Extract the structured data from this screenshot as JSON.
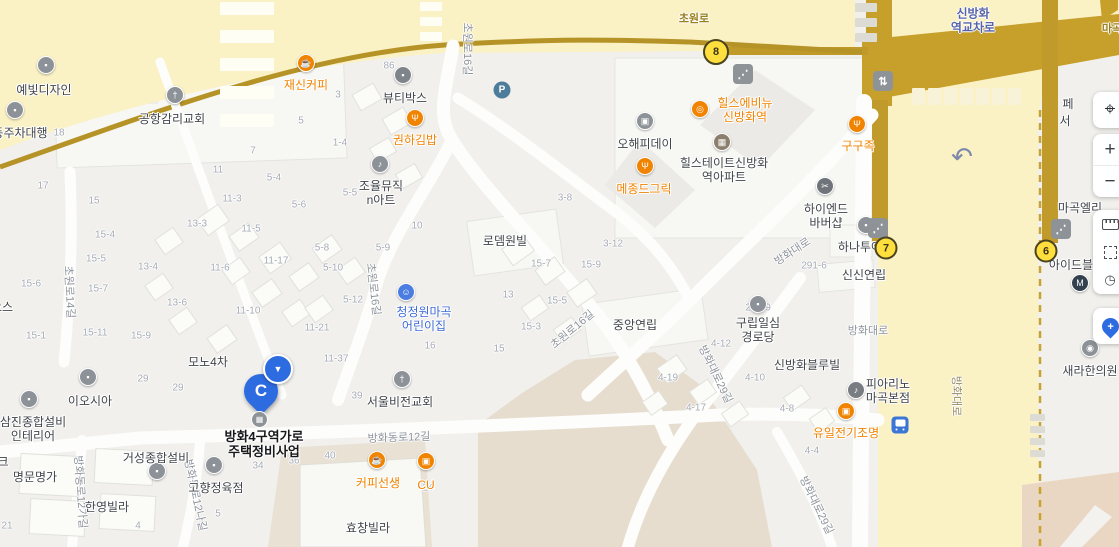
{
  "map": {
    "selected_place": {
      "line1": "방화4구역가로",
      "line2": "주택정비사업",
      "marker_letter": "C"
    },
    "controls": {
      "locate_glyph": "⌖",
      "zoom_in": "+",
      "zoom_out": "−",
      "dial_glyph": "◷",
      "add_pin": "+"
    },
    "icon_glyphs": {
      "coffee": "☕",
      "restaurant": "Ψ",
      "music": "♪",
      "church": "†",
      "apartment": "▦",
      "store": "▣",
      "dot": "▪",
      "child": "☺",
      "scissors": "✂",
      "eye": "◉",
      "ring": "◎",
      "piano": "♪",
      "parking": "P",
      "elevator": "⇅",
      "escalator": "⋰",
      "subway": "M",
      "uturn": "↶",
      "bus": "",
      "marker_arrow": "▼",
      "building": "▦"
    },
    "pois": [
      {
        "lines": [
          "재신커피"
        ],
        "x": 306,
        "y": 78,
        "cls": "orange",
        "icon": {
          "n": "coffee",
          "c": "#f08300",
          "x": 306,
          "y": 63
        }
      },
      {
        "lines": [
          "권하김밥"
        ],
        "x": 415,
        "y": 133,
        "cls": "orange",
        "icon": {
          "n": "restaurant",
          "c": "#f08300",
          "x": 415,
          "y": 118
        }
      },
      {
        "lines": [
          "메종드그릭"
        ],
        "x": 644,
        "y": 182,
        "cls": "orange",
        "icon": {
          "n": "restaurant",
          "c": "#f08300",
          "x": 645,
          "y": 166
        }
      },
      {
        "lines": [
          "힐스에비뉴",
          "신방화역"
        ],
        "x": 745,
        "y": 96,
        "cls": "orange",
        "icon": {
          "n": "ring",
          "c": "#f08300",
          "x": 700,
          "y": 109
        }
      },
      {
        "lines": [
          "구구족"
        ],
        "x": 858,
        "y": 139,
        "cls": "orange",
        "icon": {
          "n": "restaurant",
          "c": "#f08300",
          "x": 857,
          "y": 124
        }
      },
      {
        "lines": [
          "커피선생"
        ],
        "x": 378,
        "y": 476,
        "cls": "orange",
        "icon": {
          "n": "coffee",
          "c": "#f08300",
          "x": 377,
          "y": 460
        }
      },
      {
        "lines": [
          "CU"
        ],
        "x": 426,
        "y": 478,
        "cls": "orange",
        "icon": {
          "n": "store",
          "c": "#f08300",
          "x": 426,
          "y": 461
        }
      },
      {
        "lines": [
          "유일전기조명"
        ],
        "x": 846,
        "y": 426,
        "cls": "orange",
        "icon": {
          "n": "store",
          "c": "#f08300",
          "x": 846,
          "y": 411
        }
      },
      {
        "lines": [
          "청정원마곡",
          "어린이집"
        ],
        "x": 424,
        "y": 305,
        "cls": "blue",
        "icon": {
          "n": "child",
          "c": "#4a7de0",
          "x": 406,
          "y": 292
        }
      },
      {
        "lines": [
          "힐스테이트신방화",
          "역아파트"
        ],
        "x": 724,
        "y": 156,
        "cls": "dark",
        "icon": {
          "n": "apartment",
          "c": "#8b7e6d",
          "x": 722,
          "y": 142
        }
      },
      {
        "lines": [
          "오해피데이"
        ],
        "x": 645,
        "y": 137,
        "cls": "dark",
        "icon": {
          "n": "store",
          "c": "#8d9298",
          "x": 645,
          "y": 121
        }
      },
      {
        "lines": [
          "뷰티박스"
        ],
        "x": 405,
        "y": 91,
        "cls": "dark",
        "icon": {
          "n": "dot",
          "c": "#7e8489",
          "x": 403,
          "y": 75
        }
      },
      {
        "lines": [
          "하이엔드",
          "바버샵"
        ],
        "x": 826,
        "y": 202,
        "cls": "dark",
        "icon": {
          "n": "scissors",
          "c": "#6f747a",
          "x": 825,
          "y": 186
        }
      },
      {
        "lines": [
          "하나투어"
        ],
        "x": 860,
        "y": 240,
        "cls": "dark",
        "icon": {
          "n": "dot",
          "c": "#8d9298",
          "x": 866,
          "y": 225
        }
      },
      {
        "lines": [
          "공항감리교회"
        ],
        "x": 172,
        "y": 112,
        "cls": "dark",
        "icon": {
          "n": "church",
          "c": "#8d9298",
          "x": 175,
          "y": 95
        }
      },
      {
        "lines": [
          "예빛디자인"
        ],
        "x": 44,
        "y": 83,
        "cls": "dark",
        "icon": {
          "n": "dot",
          "c": "#8d9298",
          "x": 46,
          "y": 65
        }
      },
      {
        "lines": [
          "동주차대행"
        ],
        "x": 20,
        "y": 126,
        "cls": "dark",
        "icon": {
          "n": "dot",
          "c": "#8d9298",
          "x": 15,
          "y": 110
        }
      },
      {
        "lines": [
          "조율뮤직",
          "n아트"
        ],
        "x": 381,
        "y": 179,
        "cls": "dark",
        "icon": {
          "n": "music",
          "c": "#8d9298",
          "x": 380,
          "y": 164
        }
      },
      {
        "lines": [
          "이오시아"
        ],
        "x": 90,
        "y": 394,
        "cls": "dark",
        "icon": {
          "n": "dot",
          "c": "#8d9298",
          "x": 88,
          "y": 377
        }
      },
      {
        "lines": [
          "삼진종합설비",
          "인테리어"
        ],
        "x": 33,
        "y": 415,
        "cls": "dark",
        "icon": {
          "n": "dot",
          "c": "#8d9298",
          "x": 29,
          "y": 399
        }
      },
      {
        "lines": [
          "고향정육점"
        ],
        "x": 216,
        "y": 481,
        "cls": "dark",
        "icon": {
          "n": "dot",
          "c": "#8d9298",
          "x": 214,
          "y": 465
        }
      },
      {
        "lines": [
          "거성종합설비"
        ],
        "x": 156,
        "y": 451,
        "cls": "dark",
        "icon": {
          "n": "dot",
          "c": "#8d9298",
          "x": 157,
          "y": 471
        }
      },
      {
        "lines": [
          "서울비전교회"
        ],
        "x": 400,
        "y": 395,
        "cls": "dark",
        "icon": {
          "n": "church",
          "c": "#8d9298",
          "x": 402,
          "y": 379
        }
      },
      {
        "lines": [
          "구립일심",
          "경로당"
        ],
        "x": 758,
        "y": 316,
        "cls": "dark",
        "icon": {
          "n": "dot",
          "c": "#8d9298",
          "x": 758,
          "y": 304
        }
      },
      {
        "lines": [
          "피아리노",
          "마곡본점"
        ],
        "x": 888,
        "y": 377,
        "cls": "dark",
        "icon": {
          "n": "piano",
          "c": "#787d82",
          "x": 856,
          "y": 390
        }
      },
      {
        "lines": [
          "새라한의원"
        ],
        "x": 1090,
        "y": 364,
        "cls": "dark",
        "icon": {
          "n": "eye",
          "c": "#8d9298",
          "x": 1090,
          "y": 348
        }
      },
      {
        "lines": [
          "로뎀원빌"
        ],
        "x": 505,
        "y": 234,
        "cls": "dark"
      },
      {
        "lines": [
          "중앙연립"
        ],
        "x": 635,
        "y": 318,
        "cls": "dark"
      },
      {
        "lines": [
          "신신연립"
        ],
        "x": 864,
        "y": 268,
        "cls": "dark"
      },
      {
        "lines": [
          "신방화블루빌"
        ],
        "x": 807,
        "y": 358,
        "cls": "dark"
      },
      {
        "lines": [
          "모노4차"
        ],
        "x": 208,
        "y": 355,
        "cls": "dark"
      },
      {
        "lines": [
          "명문명가"
        ],
        "x": 35,
        "y": 470,
        "cls": "dark"
      },
      {
        "lines": [
          "한영빌라"
        ],
        "x": 107,
        "y": 500,
        "cls": "dark"
      },
      {
        "lines": [
          "효창빌라"
        ],
        "x": 368,
        "y": 521,
        "cls": "dark"
      },
      {
        "lines": [
          "아이드블"
        ],
        "x": 1071,
        "y": 258,
        "cls": "dark",
        "icon": {
          "n": "subway",
          "c": "#33414f",
          "x": 1080,
          "y": 283
        }
      },
      {
        "lines": [
          "마곡엘리"
        ],
        "x": 1080,
        "y": 201,
        "cls": "dark"
      },
      {
        "lines": [
          "페"
        ],
        "x": 1068,
        "y": 97,
        "cls": "dark"
      },
      {
        "lines": [
          "서"
        ],
        "x": 1065,
        "y": 114,
        "cls": "dark"
      },
      {
        "lines": [
          "오스"
        ],
        "x": 2,
        "y": 300,
        "cls": "dark"
      },
      {
        "lines": [
          "크"
        ],
        "x": 3,
        "y": 455,
        "cls": "dark"
      }
    ],
    "roads": [
      {
        "t": "초원로",
        "x": 694,
        "y": 18,
        "rot": 0,
        "cls": "o"
      },
      {
        "t": "마곡",
        "x": 1112,
        "y": 28,
        "rot": 0,
        "cls": "o"
      },
      {
        "t": "신방화",
        "x": 973,
        "y": 13,
        "rot": 0,
        "cls": "b"
      },
      {
        "t": "역교차로",
        "x": 973,
        "y": 27,
        "rot": 0,
        "cls": "b"
      },
      {
        "t": "초원로16길",
        "x": 468,
        "y": 49,
        "rot": 90,
        "cls": "g"
      },
      {
        "t": "초원로16길",
        "x": 374,
        "y": 289,
        "rot": 83,
        "cls": "g"
      },
      {
        "t": "초원로16길",
        "x": 572,
        "y": 329,
        "rot": -40,
        "cls": "g"
      },
      {
        "t": "초원로14길",
        "x": 70,
        "y": 292,
        "rot": 87,
        "cls": "g"
      },
      {
        "t": "방화동로12길",
        "x": 399,
        "y": 437,
        "rot": -2,
        "cls": "g"
      },
      {
        "t": "방화동로12가길",
        "x": 81,
        "y": 492,
        "rot": 86,
        "cls": "g"
      },
      {
        "t": "방화동로12나길",
        "x": 196,
        "y": 495,
        "rot": 78,
        "cls": "g"
      },
      {
        "t": "방화대로",
        "x": 792,
        "y": 251,
        "rot": -33,
        "cls": "g"
      },
      {
        "t": "방화대로",
        "x": 868,
        "y": 330,
        "rot": 0,
        "cls": "g"
      },
      {
        "t": "방화대로",
        "x": 957,
        "y": 396,
        "rot": 90,
        "cls": "y"
      },
      {
        "t": "방화대로29길",
        "x": 716,
        "y": 374,
        "rot": 64,
        "cls": "g"
      },
      {
        "t": "방화대로29길",
        "x": 817,
        "y": 505,
        "rot": 64,
        "cls": "g"
      }
    ],
    "lots": [
      {
        "n": "86",
        "x": 389,
        "y": 66
      },
      {
        "n": "3",
        "x": 338,
        "y": 95
      },
      {
        "n": "5",
        "x": 301,
        "y": 121
      },
      {
        "n": "1-4",
        "x": 340,
        "y": 143
      },
      {
        "n": "7",
        "x": 253,
        "y": 151
      },
      {
        "n": "11",
        "x": 218,
        "y": 170
      },
      {
        "n": "5-4",
        "x": 274,
        "y": 178
      },
      {
        "n": "5-5",
        "x": 350,
        "y": 193
      },
      {
        "n": "5-6",
        "x": 299,
        "y": 205
      },
      {
        "n": "18",
        "x": 59,
        "y": 133
      },
      {
        "n": "17",
        "x": 43,
        "y": 186
      },
      {
        "n": "15",
        "x": 94,
        "y": 201
      },
      {
        "n": "11-3",
        "x": 232,
        "y": 199
      },
      {
        "n": "13-3",
        "x": 197,
        "y": 224
      },
      {
        "n": "11-5",
        "x": 251,
        "y": 229
      },
      {
        "n": "15-4",
        "x": 105,
        "y": 235
      },
      {
        "n": "5-8",
        "x": 322,
        "y": 248
      },
      {
        "n": "5-9",
        "x": 383,
        "y": 248
      },
      {
        "n": "10",
        "x": 417,
        "y": 226
      },
      {
        "n": "3-8",
        "x": 565,
        "y": 198
      },
      {
        "n": "5-10",
        "x": 333,
        "y": 268
      },
      {
        "n": "11-17",
        "x": 276,
        "y": 261
      },
      {
        "n": "11-6",
        "x": 220,
        "y": 268
      },
      {
        "n": "15-5",
        "x": 96,
        "y": 259
      },
      {
        "n": "13-4",
        "x": 148,
        "y": 267
      },
      {
        "n": "15-6",
        "x": 31,
        "y": 284
      },
      {
        "n": "15-7",
        "x": 98,
        "y": 289
      },
      {
        "n": "3-12",
        "x": 613,
        "y": 244
      },
      {
        "n": "15-7",
        "x": 541,
        "y": 264
      },
      {
        "n": "15-9",
        "x": 591,
        "y": 265
      },
      {
        "n": "291-6",
        "x": 814,
        "y": 266
      },
      {
        "n": "13-6",
        "x": 177,
        "y": 303
      },
      {
        "n": "5-12",
        "x": 353,
        "y": 300
      },
      {
        "n": "15-1",
        "x": 36,
        "y": 336
      },
      {
        "n": "15-11",
        "x": 95,
        "y": 333
      },
      {
        "n": "15-9",
        "x": 141,
        "y": 336
      },
      {
        "n": "11-10",
        "x": 248,
        "y": 311
      },
      {
        "n": "291-9",
        "x": 758,
        "y": 308
      },
      {
        "n": "13",
        "x": 508,
        "y": 295
      },
      {
        "n": "15-5",
        "x": 557,
        "y": 301
      },
      {
        "n": "11-21",
        "x": 317,
        "y": 328
      },
      {
        "n": "16",
        "x": 430,
        "y": 346
      },
      {
        "n": "15-3",
        "x": 531,
        "y": 327
      },
      {
        "n": "11-37",
        "x": 336,
        "y": 359
      },
      {
        "n": "15",
        "x": 499,
        "y": 349
      },
      {
        "n": "4-12",
        "x": 721,
        "y": 344
      },
      {
        "n": "29",
        "x": 143,
        "y": 379
      },
      {
        "n": "29",
        "x": 178,
        "y": 388
      },
      {
        "n": "4-19",
        "x": 668,
        "y": 378
      },
      {
        "n": "4-10",
        "x": 755,
        "y": 378
      },
      {
        "n": "39",
        "x": 357,
        "y": 396
      },
      {
        "n": "4-17",
        "x": 696,
        "y": 408
      },
      {
        "n": "4-8",
        "x": 787,
        "y": 409
      },
      {
        "n": "4-4",
        "x": 812,
        "y": 451
      },
      {
        "n": "36",
        "x": 294,
        "y": 461
      },
      {
        "n": "40",
        "x": 330,
        "y": 456
      },
      {
        "n": "34",
        "x": 258,
        "y": 466
      },
      {
        "n": "24",
        "x": 428,
        "y": 488
      },
      {
        "n": "21",
        "x": 7,
        "y": 526
      },
      {
        "n": "4",
        "x": 138,
        "y": 526
      },
      {
        "n": "5",
        "x": 218,
        "y": 514
      }
    ],
    "exits": [
      {
        "n": "8",
        "x": 716,
        "y": 52,
        "d": 22
      },
      {
        "n": "7",
        "x": 886,
        "y": 248,
        "d": 19
      },
      {
        "n": "6",
        "x": 1046,
        "y": 251,
        "d": 19
      }
    ],
    "symbols": [
      {
        "t": "escalator",
        "x": 743,
        "y": 74
      },
      {
        "t": "escalator",
        "x": 878,
        "y": 228
      },
      {
        "t": "escalator",
        "x": 1061,
        "y": 229
      },
      {
        "t": "elevator",
        "x": 883,
        "y": 81
      },
      {
        "t": "parking",
        "x": 502,
        "y": 90
      },
      {
        "t": "bus",
        "x": 900,
        "y": 425
      },
      {
        "t": "uturn",
        "x": 962,
        "y": 157
      }
    ]
  }
}
